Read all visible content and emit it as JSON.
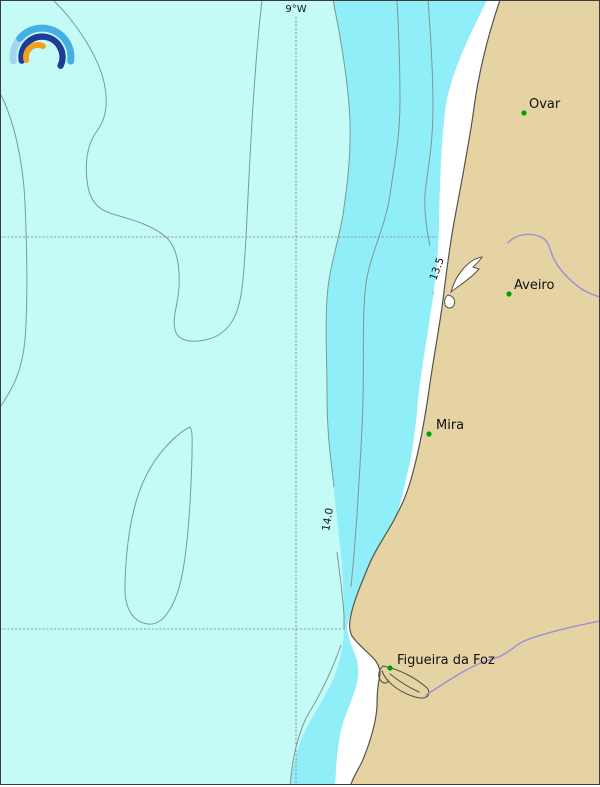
{
  "map": {
    "type": "coastal-isoline-map",
    "graticule": {
      "lon_label": "9°W"
    },
    "isotherms": [
      {
        "value": "13.5"
      },
      {
        "value": "14.0"
      }
    ],
    "cities": [
      {
        "name": "Ovar"
      },
      {
        "name": "Aveiro"
      },
      {
        "name": "Mira"
      },
      {
        "name": "Figueira da Foz"
      }
    ],
    "colors": {
      "ocean_offshore": "#c4fbf6",
      "ocean_nearshore": "#8feef7",
      "beach": "#ffffff",
      "land": "#e6d3a3",
      "coastline": "#55544a",
      "contour": "#7d9899",
      "graticule": "#8f9898",
      "river": "#9b8ed8",
      "city_marker": "#00a000",
      "label_text": "#111111",
      "logo_outer_light": "#9fd6f0",
      "logo_outer": "#45aee3",
      "logo_middle": "#1e3c96",
      "logo_inner": "#f6a01a"
    }
  }
}
